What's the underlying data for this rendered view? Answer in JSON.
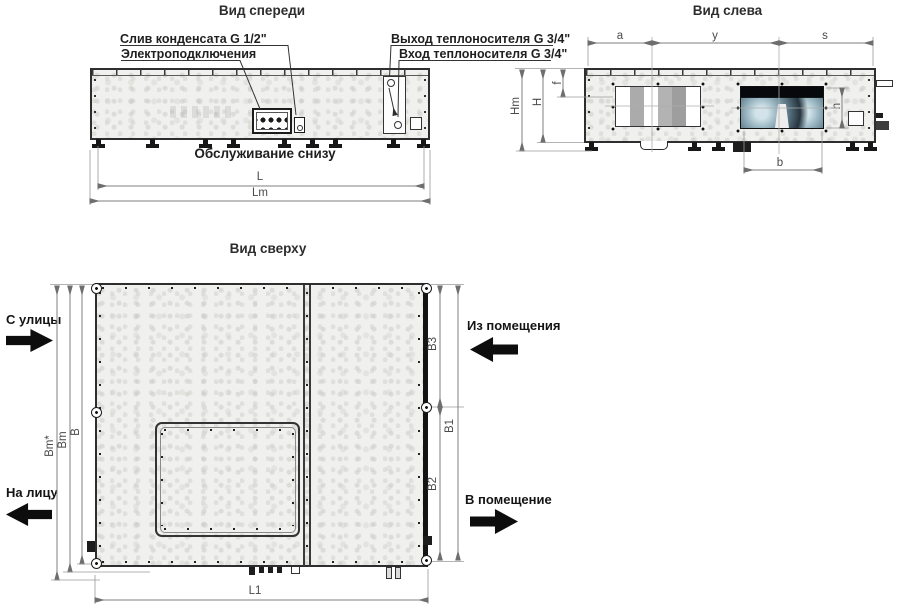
{
  "titles": {
    "front_view": "Вид спереди",
    "left_view": "Вид слева",
    "top_view": "Вид сверху"
  },
  "front_view": {
    "callouts": {
      "condensate_drain": "Слив конденсата G 1/2\"",
      "electrical_connections": "Электроподключения",
      "heat_carrier_outlet": "Выход теплоносителя G 3/4\"",
      "heat_carrier_inlet": "Вход теплоносителя G 3/4\"",
      "service_from_below": "Обслуживание снизу"
    },
    "dimensions": {
      "L": "L",
      "Lm": "Lm"
    }
  },
  "left_view": {
    "dimensions": {
      "a": "a",
      "y": "y",
      "s": "s",
      "f": "f",
      "H": "H",
      "Hm": "Hm",
      "h": "h",
      "b": "b"
    }
  },
  "top_view": {
    "flow": {
      "from_street": "С улицы",
      "to_street": "На лицу",
      "from_room": "Из помещения",
      "to_room": "В помещение"
    },
    "dimensions": {
      "B": "B",
      "Bm": "Bm",
      "Bm_star": "Bm*",
      "B1": "B1",
      "B2": "B2",
      "B3": "B3",
      "L1": "L1"
    }
  },
  "colors": {
    "linework": "#2e2e2e",
    "dimension_line": "#7f7f7f",
    "flow_arrow": "#0d0d0d"
  }
}
